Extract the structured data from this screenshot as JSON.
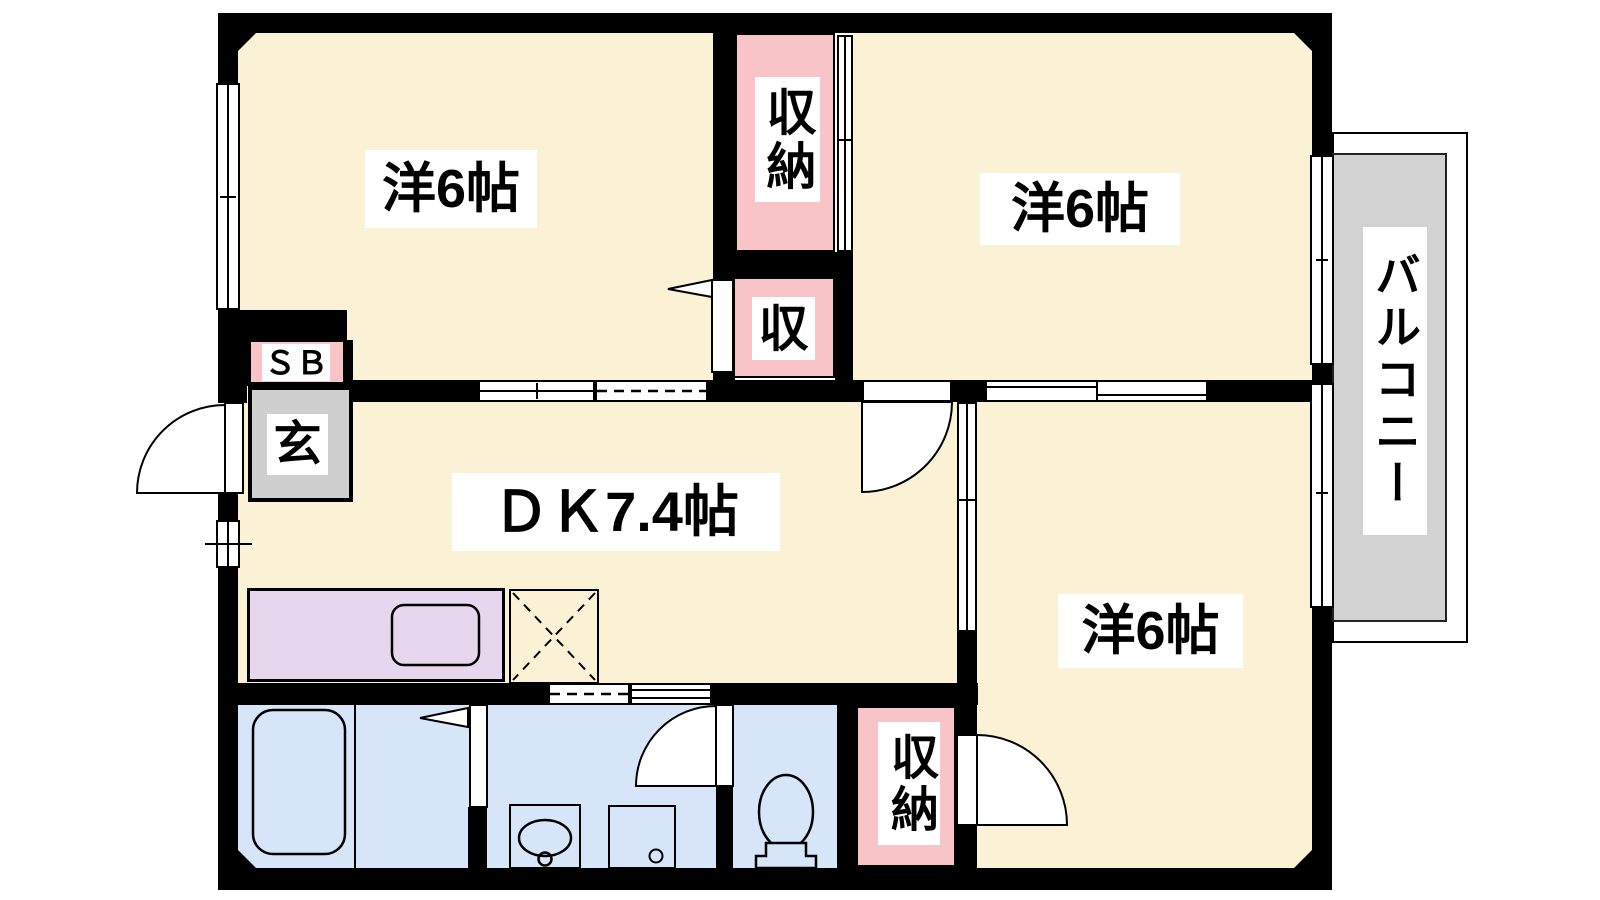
{
  "plan": {
    "rooms": {
      "room_top_left": {
        "label": "洋6帖"
      },
      "room_top_right": {
        "label": "洋6帖"
      },
      "room_bottom_right": {
        "label": "洋6帖"
      },
      "dining_kitchen": {
        "label": "ＤＫ7.4帖"
      },
      "closet_top": {
        "label": "収納"
      },
      "closet_mid": {
        "label": "収"
      },
      "closet_bottom": {
        "label": "収納"
      },
      "shoe_box": {
        "label": "ＳＢ"
      },
      "entrance": {
        "label": "玄"
      },
      "balcony": {
        "label": "バルコニー"
      }
    },
    "colors": {
      "floor": "#FBF2D5",
      "closet_pink": "#F8C4C8",
      "entrance_gray": "#CFCFCF",
      "balcony_gray": "#D2D2D2",
      "kitchen_purple": "#E6D6EE",
      "wet_area_blue": "#D6E6F8",
      "wall": "#000000"
    },
    "fixtures": [
      "bathtub",
      "wash-basin",
      "washing-machine",
      "toilet",
      "kitchen-sink",
      "refrigerator-space",
      "entry-door",
      "room-doors",
      "sliding-doors",
      "windows"
    ]
  }
}
